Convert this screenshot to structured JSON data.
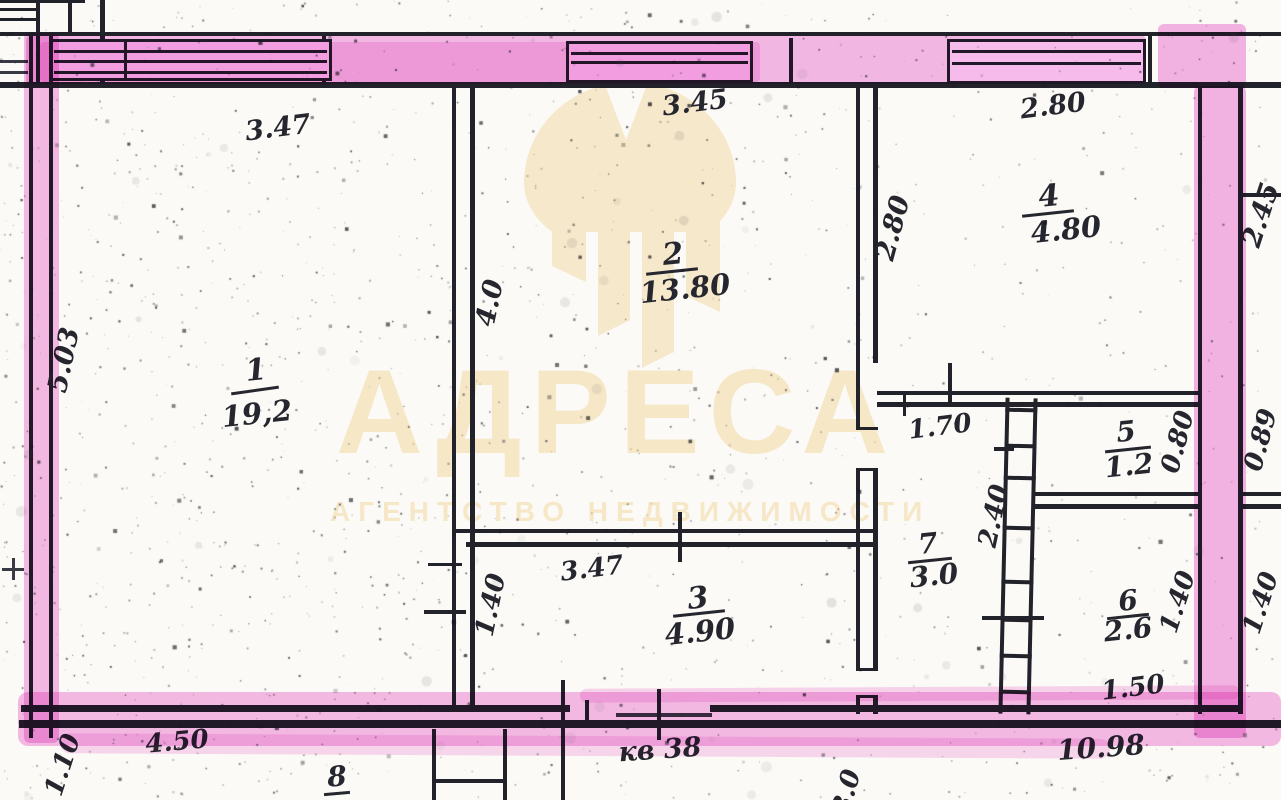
{
  "watermark": {
    "brand": "АДРЕСА",
    "tagline": "АГЕНТСТВО НЕДВИЖИМОСТИ"
  },
  "rooms": {
    "r1": {
      "number": "1",
      "area": "19,2"
    },
    "r2": {
      "number": "2",
      "area": "13.80"
    },
    "r3": {
      "number": "3",
      "area": "4.90"
    },
    "r4": {
      "number": "4",
      "area": "4.80"
    },
    "r5": {
      "number": "5",
      "area": "1.2"
    },
    "r6": {
      "number": "6",
      "area": "2.6"
    },
    "r7": {
      "number": "7",
      "area": "3.0"
    },
    "r8": {
      "number": "8"
    }
  },
  "dims": {
    "top_left": "3.47",
    "top_mid": "3.45",
    "top_right": "2.80",
    "left_side": "5.03",
    "room1_2_wall": "4.0",
    "room2_4_wall": "2.80",
    "right_top": "2.45",
    "hall_width": "1.70",
    "wc_width": "0.80",
    "right_mid": "0.89",
    "hall_height": "2.40",
    "room3_width": "3.47",
    "room3_height": "1.40",
    "bath_height_in": "1.40",
    "right_lower": "1.40",
    "bath_width": "1.50",
    "bottom_right": "10.98",
    "bottom_left": "4.50",
    "bottom_corner": "1.10",
    "bottom_partial": "3.0"
  },
  "entrance": {
    "apartment": "кв 38"
  },
  "colors": {
    "highlighter": "#ee7ad6",
    "ink": "#22222b",
    "watermark": "#f6e7c7",
    "paper": "#fbfaf6"
  }
}
